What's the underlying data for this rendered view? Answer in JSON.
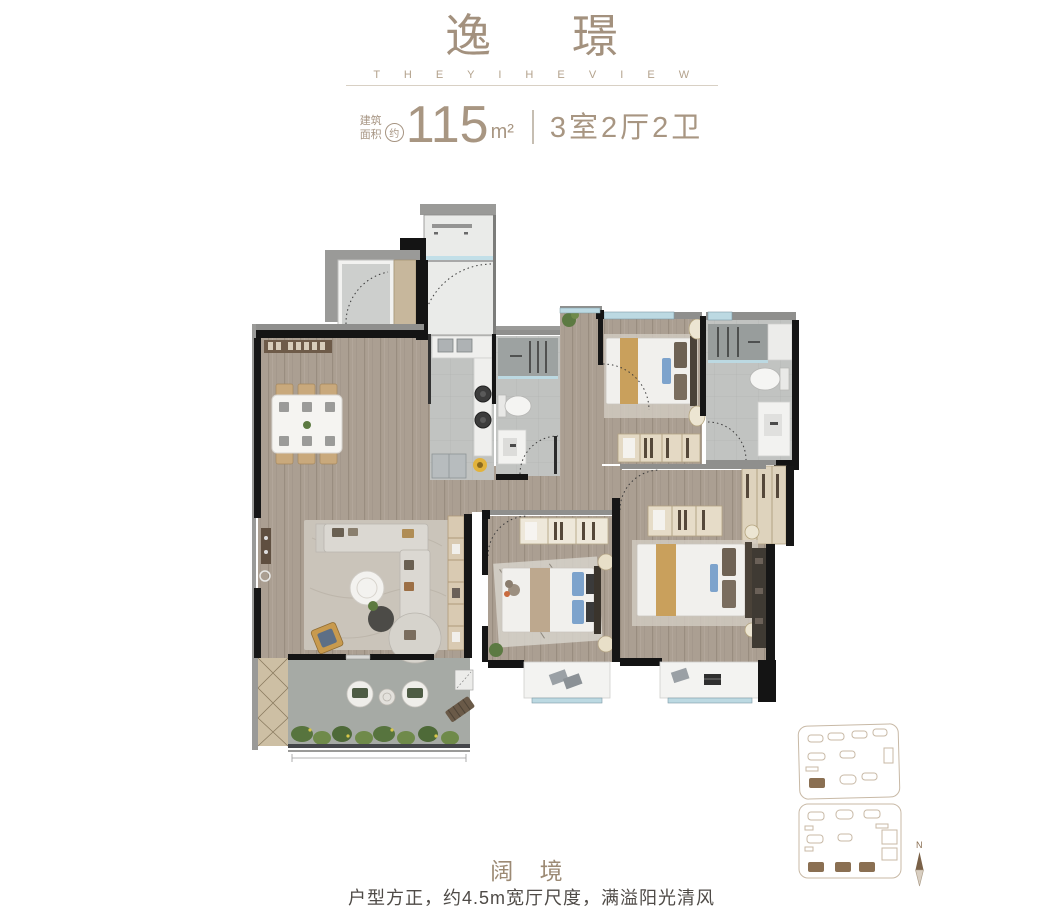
{
  "header": {
    "title": "逸 璟",
    "subtitle": "T H E   Y I H E   V I E W",
    "spec": {
      "area_label_line1": "建筑",
      "area_label_line2": "面积",
      "approx_badge": "约",
      "area_value": "115",
      "area_unit": "m²",
      "layout_text": "3室2厅2卫"
    }
  },
  "footer": {
    "headline": "阔 境",
    "description": "户型方正，约4.5m宽厅尺度，满溢阳光清风"
  },
  "site_plan": {
    "compass_label": "N"
  },
  "colors": {
    "accent_brown": "#a3917e",
    "spec_brown": "#a89682",
    "footer_text_gray": "#4f4b47",
    "wall_dark": "#161616",
    "wall_gray": "#9a9a98",
    "wood_floor": "#ab9f92",
    "tile_gray": "#c1c3c1",
    "balcony_concrete": "#a6aaa5",
    "window_blue": "#bcd9e2",
    "furniture_white": "#f1f0ed",
    "blanket_tan": "#c9a05c",
    "pillow_blue": "#7da3cc",
    "site_outline": "#c8b9a6",
    "site_filled": "#8a6f52",
    "plant_green": "#5c7a42"
  }
}
